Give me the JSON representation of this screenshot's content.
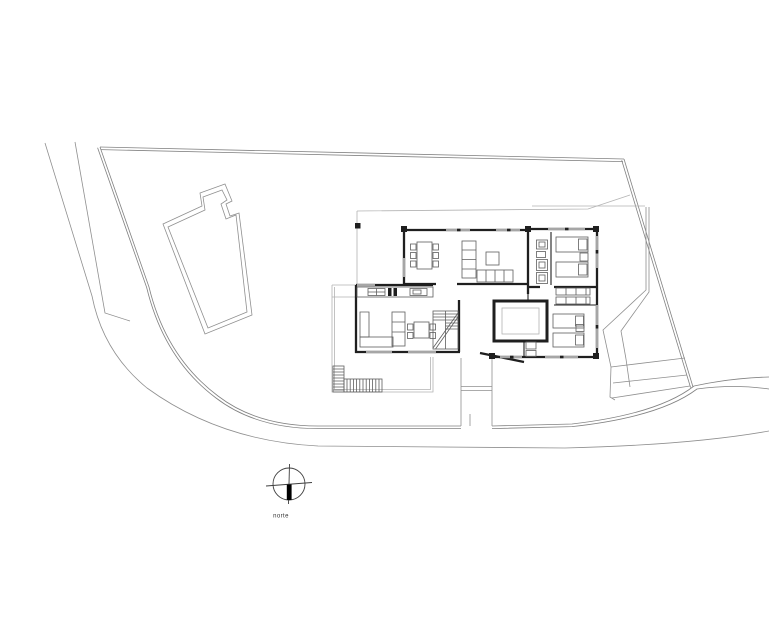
{
  "drawing": {
    "type": "architectural-site-plan",
    "background": "#ffffff"
  },
  "colors": {
    "site_line": "#8f8f8f",
    "boundary_line": "#828282",
    "thin_outline": "#b3b3b3",
    "wall": "#1f1f1f",
    "window": "#a6a6a6",
    "furniture": "#5e5e5e",
    "compass": "#3f3f3f",
    "compass_bar": "#000000",
    "label_text": "#333333"
  },
  "compass": {
    "label": "norte"
  }
}
